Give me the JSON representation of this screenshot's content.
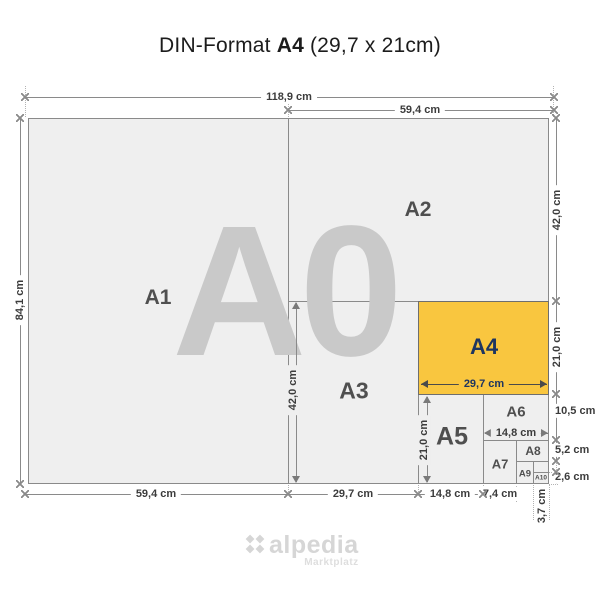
{
  "title": {
    "prefix": "DIN-Format",
    "format": "A4",
    "size": "(29,7 x 21cm)"
  },
  "watermark": "A0",
  "labels": {
    "a1": "A1",
    "a2": "A2",
    "a3": "A3",
    "a4": "A4",
    "a5": "A5",
    "a6": "A6",
    "a7": "A7",
    "a8": "A8",
    "a9": "A9",
    "a10": "A10"
  },
  "dims": {
    "a0_width": "118,9 cm",
    "a2_width_top": "59,4 cm",
    "a0_height": "84,1 cm",
    "a2_height": "42,0 cm",
    "a4_height": "21,0 cm",
    "a6_height": "10,5 cm",
    "a8_height": "5,2 cm",
    "a10_height": "2,6 cm",
    "a1_width_bottom": "59,4 cm",
    "a3_width": "29,7 cm",
    "a5_width": "14,8 cm",
    "a7_width": "7,4 cm",
    "a10_width": "3,7 cm",
    "a3_height": "42,0 cm",
    "a5_height": "21,0 cm",
    "a4_width": "29,7 cm",
    "a6_width": "14,8 cm"
  },
  "logo": {
    "name": "alpedia",
    "tagline": "Marktplatz"
  },
  "colors": {
    "highlight": "#F9C63F",
    "highlight_border": "#6E6E6E",
    "highlight_text": "#1E3560",
    "paper": "#EFEFEF",
    "watermark": "#C9C9C9",
    "line": "#8A8A8A",
    "dim_text": "#3C3C3C",
    "logo_text": "#D6D6D6"
  }
}
